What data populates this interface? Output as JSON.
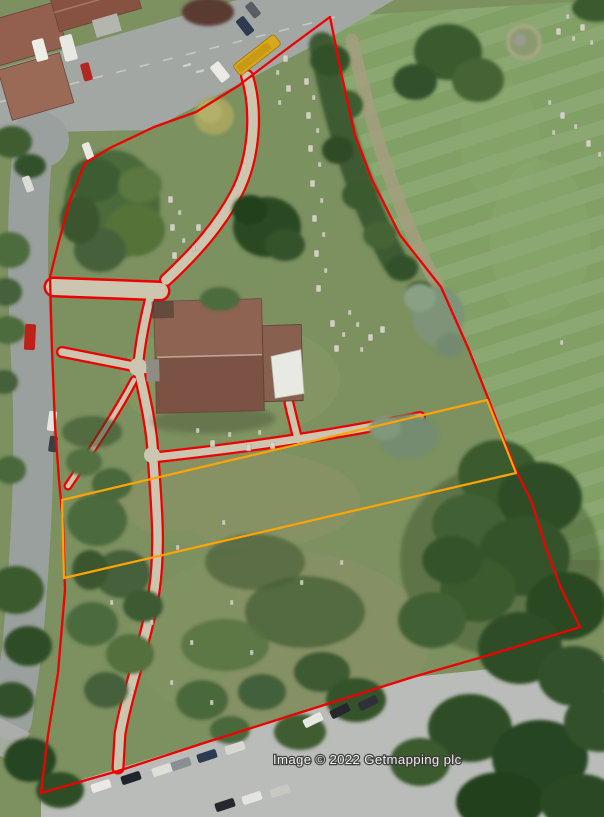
{
  "map": {
    "credit": "Image © 2022 Getmapping plc",
    "overlay": {
      "boundary_color": "#ee0000",
      "parcel_strip_color": "#ffa400"
    },
    "features": {
      "site": "churchyard-aerial-view",
      "building": "church",
      "north_field": "striped-meadow",
      "south_area": "parking-lot"
    }
  }
}
